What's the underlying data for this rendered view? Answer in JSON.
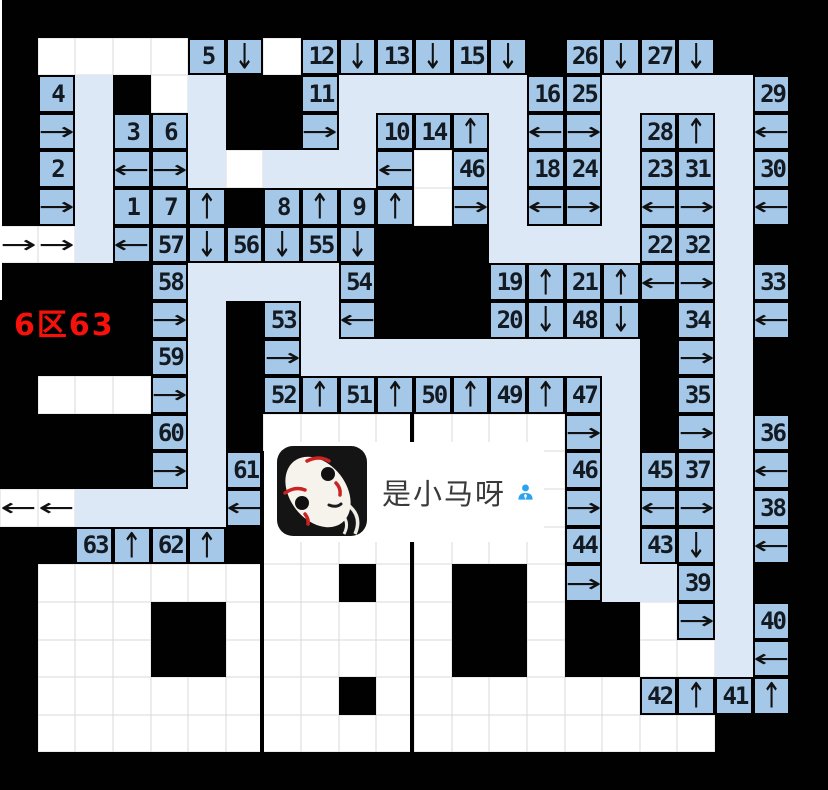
{
  "region_label": {
    "text": "6区63",
    "color": "#f6120b"
  },
  "watermark": {
    "text": "是小马呀",
    "icon": "person-icon",
    "avatar": "no-face-mask-avatar"
  },
  "colors": {
    "wall": "#010101",
    "empty": "#ffffff",
    "path": "#dce8f5",
    "piece": "#a6c8e8",
    "piece_border": "#000000",
    "number_text": "#141a22",
    "label_red": "#f6120b",
    "icon_blue": "#2ba3ee"
  },
  "grid": {
    "cols": 22,
    "rows_count": 21,
    "legend": {
      "B": "wall",
      "W": "empty",
      "L": "path",
      "n#": "number-piece",
      "aU/aD/aL/aR": "arrow-piece",
      "wL/wR": "arrow-on-empty"
    },
    "rows": [
      [
        "B",
        "B",
        "B",
        "B",
        "B",
        "B",
        "B",
        "B",
        "B",
        "B",
        "B",
        "B",
        "B",
        "B",
        "B",
        "B",
        "B",
        "B",
        "B",
        "B",
        "B",
        "B"
      ],
      [
        "B",
        "W",
        "W",
        "W",
        "W",
        "n5",
        "aD",
        "W",
        "n12",
        "aD",
        "n13",
        "aD",
        "n15",
        "aD",
        "B",
        "n26",
        "aD",
        "n27",
        "aD",
        "B",
        "B",
        "B"
      ],
      [
        "B",
        "n4",
        "L",
        "B",
        "W",
        "L",
        "B",
        "B",
        "n11",
        "L",
        "L",
        "L",
        "L",
        "L",
        "n16",
        "n25",
        "L",
        "L",
        "L",
        "L",
        "n29",
        "B"
      ],
      [
        "B",
        "aR",
        "L",
        "n3",
        "n6",
        "L",
        "B",
        "B",
        "aR",
        "L",
        "n10",
        "n14",
        "aU",
        "L",
        "aL",
        "aR",
        "L",
        "n28",
        "aU",
        "L",
        "aL",
        "B"
      ],
      [
        "B",
        "n2",
        "L",
        "aL",
        "aR",
        "L",
        "W",
        "L",
        "L",
        "L",
        "aL",
        "W",
        "n46",
        "L",
        "n18",
        "n24",
        "L",
        "n23",
        "n31",
        "L",
        "n30",
        "B"
      ],
      [
        "B",
        "aR",
        "L",
        "n1",
        "n7",
        "aU",
        "B",
        "n8",
        "aU",
        "n9",
        "aU",
        "W",
        "aR",
        "L",
        "aL",
        "aR",
        "L",
        "aL",
        "aR",
        "L",
        "aL",
        "B"
      ],
      [
        "wR",
        "wR",
        "L",
        "aL",
        "n57",
        "aD",
        "n56",
        "aD",
        "n55",
        "aD",
        "B",
        "B",
        "B",
        "L",
        "L",
        "L",
        "L",
        "n22",
        "n32",
        "L",
        "B",
        "B"
      ],
      [
        "B",
        "B",
        "B",
        "B",
        "n58",
        "L",
        "L",
        "L",
        "L",
        "n54",
        "B",
        "B",
        "B",
        "n19",
        "aU",
        "n21",
        "aU",
        "aL",
        "aR",
        "L",
        "n33",
        "B"
      ],
      [
        "B",
        "B",
        "B",
        "B",
        "aR",
        "L",
        "B",
        "n53",
        "L",
        "aL",
        "B",
        "B",
        "B",
        "n20",
        "aD",
        "n48",
        "aD",
        "B",
        "n34",
        "L",
        "aL",
        "B"
      ],
      [
        "B",
        "B",
        "B",
        "B",
        "n59",
        "L",
        "B",
        "aR",
        "L",
        "L",
        "L",
        "L",
        "L",
        "L",
        "L",
        "L",
        "L",
        "B",
        "aR",
        "L",
        "B",
        "B"
      ],
      [
        "B",
        "W",
        "W",
        "W",
        "aR",
        "L",
        "B",
        "n52",
        "aU",
        "n51",
        "aU",
        "n50",
        "aU",
        "n49",
        "aU",
        "n47",
        "L",
        "B",
        "n35",
        "L",
        "B",
        "B"
      ],
      [
        "B",
        "B",
        "B",
        "B",
        "n60",
        "L",
        "B",
        "W",
        "W",
        "W",
        "W",
        "W",
        "W",
        "W",
        "W",
        "aR",
        "L",
        "B",
        "aR",
        "L",
        "n36",
        "B"
      ],
      [
        "B",
        "B",
        "B",
        "B",
        "aR",
        "L",
        "n61",
        "W",
        "W",
        "W",
        "W",
        "W",
        "W",
        "W",
        "W",
        "n46",
        "L",
        "n45",
        "n37",
        "L",
        "aL",
        "B"
      ],
      [
        "wL",
        "wL",
        "L",
        "L",
        "L",
        "L",
        "aL",
        "W",
        "W",
        "W",
        "W",
        "W",
        "W",
        "W",
        "W",
        "aR",
        "L",
        "aL",
        "aR",
        "L",
        "n38",
        "B"
      ],
      [
        "B",
        "B",
        "n63",
        "aU",
        "n62",
        "aU",
        "B",
        "W",
        "W",
        "W",
        "W",
        "W",
        "W",
        "W",
        "W",
        "n44",
        "L",
        "n43",
        "aD",
        "L",
        "aL",
        "B"
      ],
      [
        "B",
        "W",
        "W",
        "W",
        "W",
        "W",
        "W",
        "W",
        "W",
        "B",
        "W",
        "W",
        "B",
        "B",
        "W",
        "aR",
        "L",
        "L",
        "n39",
        "L",
        "B",
        "B"
      ],
      [
        "B",
        "W",
        "W",
        "W",
        "B",
        "B",
        "W",
        "W",
        "W",
        "W",
        "W",
        "W",
        "B",
        "B",
        "W",
        "B",
        "B",
        "W",
        "aR",
        "L",
        "n40",
        "B"
      ],
      [
        "B",
        "W",
        "W",
        "W",
        "B",
        "B",
        "W",
        "W",
        "W",
        "W",
        "W",
        "W",
        "B",
        "B",
        "W",
        "B",
        "B",
        "W",
        "W",
        "L",
        "aL",
        "B"
      ],
      [
        "B",
        "W",
        "W",
        "W",
        "W",
        "W",
        "W",
        "W",
        "W",
        "B",
        "W",
        "W",
        "W",
        "W",
        "W",
        "W",
        "W",
        "n42",
        "aU",
        "n41",
        "aU",
        "B"
      ],
      [
        "B",
        "W",
        "W",
        "W",
        "W",
        "W",
        "W",
        "W",
        "W",
        "W",
        "W",
        "W",
        "W",
        "W",
        "W",
        "W",
        "W",
        "W",
        "W",
        "B",
        "B",
        "B"
      ],
      [
        "B",
        "B",
        "B",
        "B",
        "B",
        "B",
        "B",
        "B",
        "B",
        "B",
        "B",
        "B",
        "B",
        "B",
        "B",
        "B",
        "B",
        "B",
        "B",
        "B",
        "B",
        "B"
      ]
    ]
  }
}
